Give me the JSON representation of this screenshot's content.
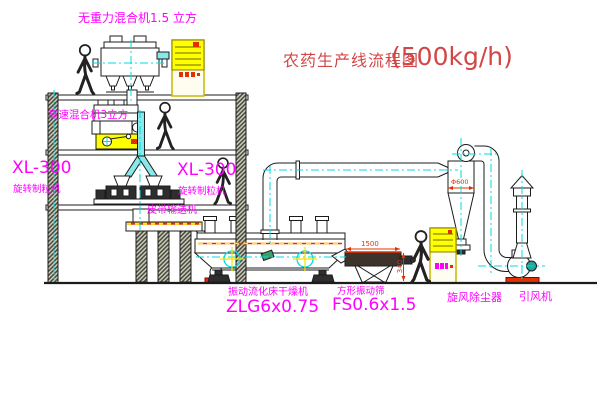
{
  "title": {
    "text": "农药生产线流程图",
    "capacity": "(500kg/h)"
  },
  "labels": {
    "gravity_mixer": "无重力混合机1.5 立方",
    "high_speed_mixer": "高速混合机3立方",
    "granulator_left_model": "XL-300",
    "granulator_left_name": "旋转制粒机",
    "granulator_right_model": "XL-300",
    "granulator_right_name": "旋转制粒机",
    "belt_conveyor": "皮带输送机",
    "dryer_name": "振动流化床干燥机",
    "dryer_model": "ZLG6x0.75",
    "sieve_name": "方形振动筛",
    "sieve_model": "FS0.6x1.5",
    "cyclone": "旋风除尘器",
    "fan": "引风机"
  },
  "dims": {
    "cyclone_diameter": "Φ600",
    "sieve_length": "1500",
    "sieve_height": "340"
  },
  "colors": {
    "label_magenta": "#ff00ff",
    "title_red": "#d34646",
    "centerline_cyan": "#00dede",
    "cabinet_yellow": "#ffff00",
    "machine_red": "#e33000",
    "belt_yellow": "#ffe900",
    "line": "#1c1c1c"
  }
}
